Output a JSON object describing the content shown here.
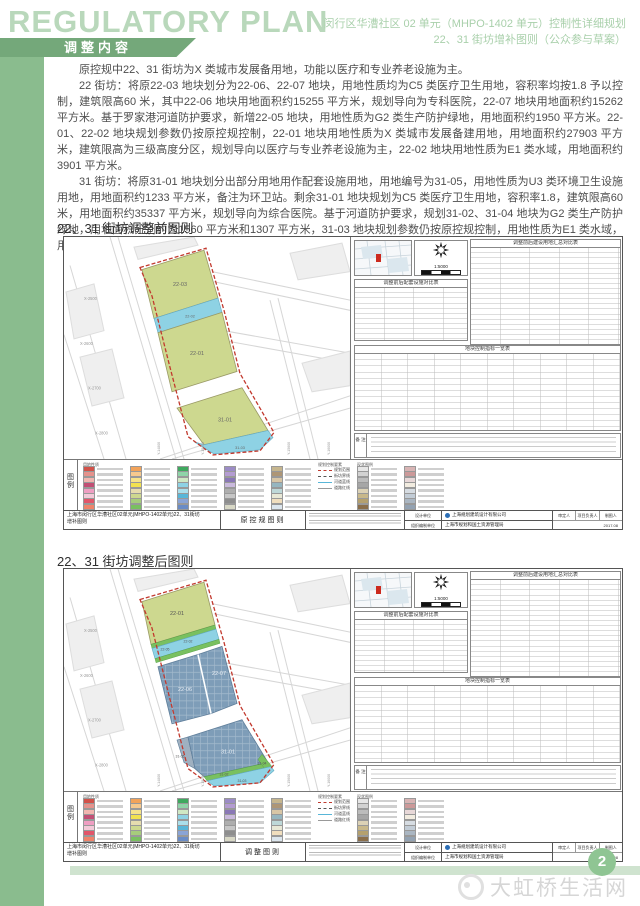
{
  "header": {
    "logo": "REGULATORY PLAN",
    "title_line1": "闵行区华漕社区 02 单元（MHPO-1402 单元）控制性详细规划",
    "title_line2": "22、31 街坊增补图则（公众参与草案）",
    "tab": "调整内容"
  },
  "body": {
    "p1": "原控规中22、31 街坊为X 类城市发展备用地，功能以医疗和专业养老设施为主。",
    "p2": "22 街坊：将原22-03 地块划分为22-06、22-07 地块，用地性质均为C5 类医疗卫生用地，容积率均按1.8 予以控制，建筑限高60 米，其中22-06 地块用地面积约15255 平方米，规划导向为专科医院，22-07 地块用地面积约15262 平方米。基于罗家港河道防护要求，新增22-05 地块，用地性质为G2 类生产防护绿地，用地面积约1950 平方米。22-01、22-02 地块规划参数仍按原控规控制，22-01 地块用地性质为X 类城市发展备建用地，用地面积约27903 平方米，建筑限高为三级高度分区，规划导向以医疗与专业养老设施为主，22-02 地块用地性质为E1 类水域，用地面积约3901 平方米。",
    "p3": "31 街坊：将原31-01 地块划分出部分用地用作配套设施用地，用地编号为31-05，用地性质为U3 类环境卫生设施用地，用地面积约1233 平方米，备注为环卫站。剩余31-01 地块规划为C5 类医疗卫生用地，容积率1.8，建筑限高60 米，用地面积约35337 平方米，规划导向为综合医院。基于河道防护要求，规划31-02、31-04 地块为G2 类生产防护绿地，用地面积分别约为1560 平方米和1307 平方米，31-03 地块规划参数仍按原控规控制，用地性质为E1 类水域，用地面积约2657 平方米。"
  },
  "sections": {
    "before": "22、31 街坊调整前图则",
    "after": "22、31 街坊调整后图则"
  },
  "map_common": {
    "scale": "1:5000",
    "facility_table_title": "调整前后配套设施对比表",
    "landuse_table_title": "调整前后建设用地汇总对比表",
    "index_table_title": "地块控制指标一览表",
    "notes_label": "备 注",
    "x_ticks": [
      "X-2500",
      "X-2600",
      "X-2700",
      "X-2800"
    ],
    "y_ticks": [
      "Y-14800",
      "Y-15200",
      "Y-15600",
      "Y-16000"
    ],
    "titleblock": {
      "project_line1": "上海市闵行区华漕社区02单元(MHPO-1402单元)22、31街坊",
      "project_line2": "增补图则",
      "design_unit_label": "设计单位",
      "org_unit_label": "组织编制单位",
      "design_unit": "上海规划建筑设计有限公司",
      "org_unit": "上海市规划和国土资源管理局",
      "staff1": "审定人",
      "staff2": "项目负责人",
      "staff3": "制图人",
      "date": "2017.08"
    }
  },
  "map_before": {
    "type_label": "原控规图则",
    "parcels": {
      "a": "22-03",
      "b": "22-02",
      "c": "22-01",
      "d": "31-01",
      "e": "31-03"
    }
  },
  "map_after": {
    "type_label": "调整图则",
    "parcels": {
      "a": "22-01",
      "b": "22-05",
      "c": "22-02",
      "d": "22-06",
      "e": "22-07",
      "f": "31-01",
      "g": "31-05",
      "h": "31-02",
      "i": "31-03",
      "j": "31-04"
    }
  },
  "legend": {
    "label": "图 例",
    "header": "用地性质",
    "ctrl_header": "规划控制要素",
    "misc_header": "现状图例",
    "colors": [
      "#d2524a",
      "#e5928c",
      "#f2b6b0",
      "#c24f75",
      "#ef9ec2",
      "#f3c9d8",
      "#e2566a",
      "#f0836a",
      "#f2a35a",
      "#f6c98e",
      "#f6e38a",
      "#f2e24f",
      "#e6dcae",
      "#cdd88f",
      "#a6cc7c",
      "#79c060",
      "#3fa95f",
      "#8fd4a8",
      "#cfe8c4",
      "#8ed2e4",
      "#aadfeb",
      "#58b6d8",
      "#8aa4d6",
      "#6a8cc6",
      "#9c8cc6",
      "#b49cd2",
      "#8a78b6",
      "#cabadd",
      "#aeaeae",
      "#c6c6c6",
      "#8e8e8e",
      "#d8d8c6",
      "#c6b68e",
      "#ae9676",
      "#d8c6a6",
      "#96b6c0",
      "#bed8d8",
      "#e8e8d6",
      "#f0debe",
      "#dce6ee"
    ],
    "misc_colors": [
      "#e6e6e6",
      "#d2d2d2",
      "#bcbcbc",
      "#a6a6a6",
      "#dcd2b6",
      "#c8b88a",
      "#b4a06e",
      "#8a6e4a",
      "#d8b4b4",
      "#cc9999",
      "#e8d8d8",
      "#f2ece0",
      "#d6dce2",
      "#c2ccd6",
      "#aab6c2",
      "#93a2b2"
    ],
    "ctrl_items": [
      {
        "label": "规划范围"
      },
      {
        "label": "街坊界线"
      },
      {
        "label": "河道蓝线"
      },
      {
        "label": "道路红线"
      }
    ]
  },
  "footer": {
    "page": "2",
    "watermark": "大虹桥生活网"
  }
}
